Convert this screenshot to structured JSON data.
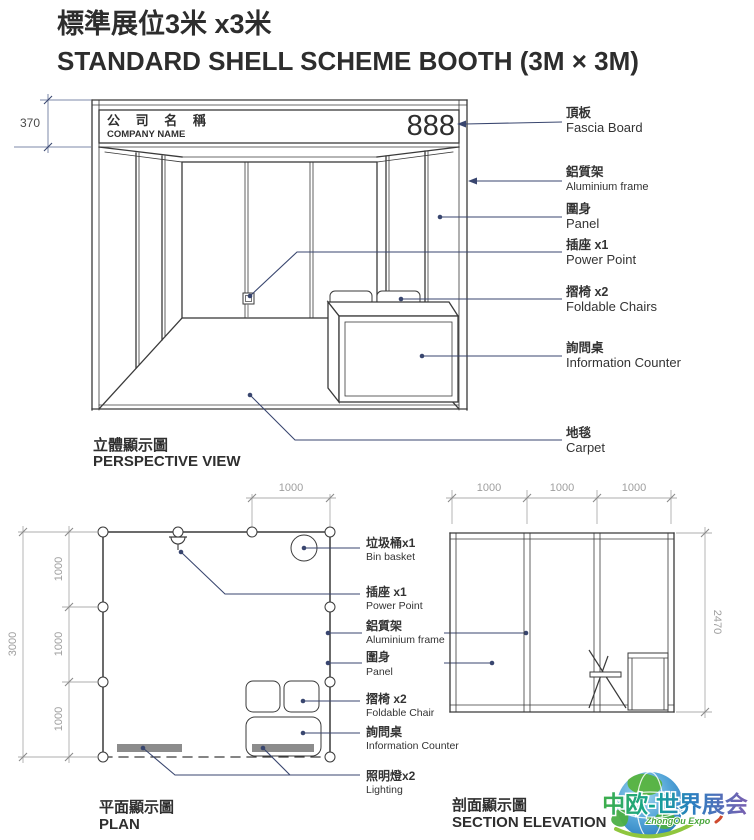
{
  "header": {
    "title_zh": "標準展位3米 x3米",
    "title_en": "STANDARD SHELL SCHEME BOOTH (3M × 3M)"
  },
  "perspective": {
    "caption_zh": "立體顯示圖",
    "caption_en": "PERSPECTIVE VIEW",
    "dim_fascia_height": "370",
    "fascia": {
      "company_zh": "公 司 名 稱",
      "company_en": "COMPANY NAME",
      "booth_number": "888"
    },
    "labels": [
      {
        "zh": "頂板",
        "en": "Fascia Board"
      },
      {
        "zh": "鋁質架",
        "en": "Aluminium frame"
      },
      {
        "zh": "圍身",
        "en": "Panel"
      },
      {
        "zh": "插座 x1",
        "en": "Power Point"
      },
      {
        "zh": "摺椅 x2",
        "en": "Foldable Chairs"
      },
      {
        "zh": "詢問桌",
        "en": "Information Counter"
      },
      {
        "zh": "地毯",
        "en": "Carpet"
      }
    ]
  },
  "plan": {
    "caption_zh": "平面顯示圖",
    "caption_en": "PLAN",
    "dim_total": "3000",
    "dim_bay": "1000",
    "dim_top_bay": "1000",
    "labels": [
      {
        "zh": "垃圾桶x1",
        "en": "Bin basket"
      },
      {
        "zh": "插座 x1",
        "en": "Power Point"
      },
      {
        "zh": "鋁質架",
        "en": "Aluminium frame"
      },
      {
        "zh": "圍身",
        "en": "Panel"
      },
      {
        "zh": "摺椅 x2",
        "en": "Foldable Chair"
      },
      {
        "zh": "詢問桌",
        "en": "Information Counter"
      },
      {
        "zh": "照明燈x2",
        "en": "Lighting"
      }
    ]
  },
  "section": {
    "caption_zh": "剖面顯示圖",
    "caption_en": "SECTION ELEVATION",
    "dim_bays": [
      "1000",
      "1000",
      "1000"
    ],
    "dim_height": "2470"
  },
  "logo": {
    "name_zh": "中欧-世界展会",
    "name_en": "ZhongOu Expo"
  },
  "colors": {
    "line": "#3a3a3a",
    "dimension": "#adadad",
    "leader": "#39466f",
    "logo_green": "#3fae49",
    "logo_blue": "#2b7fc1"
  }
}
